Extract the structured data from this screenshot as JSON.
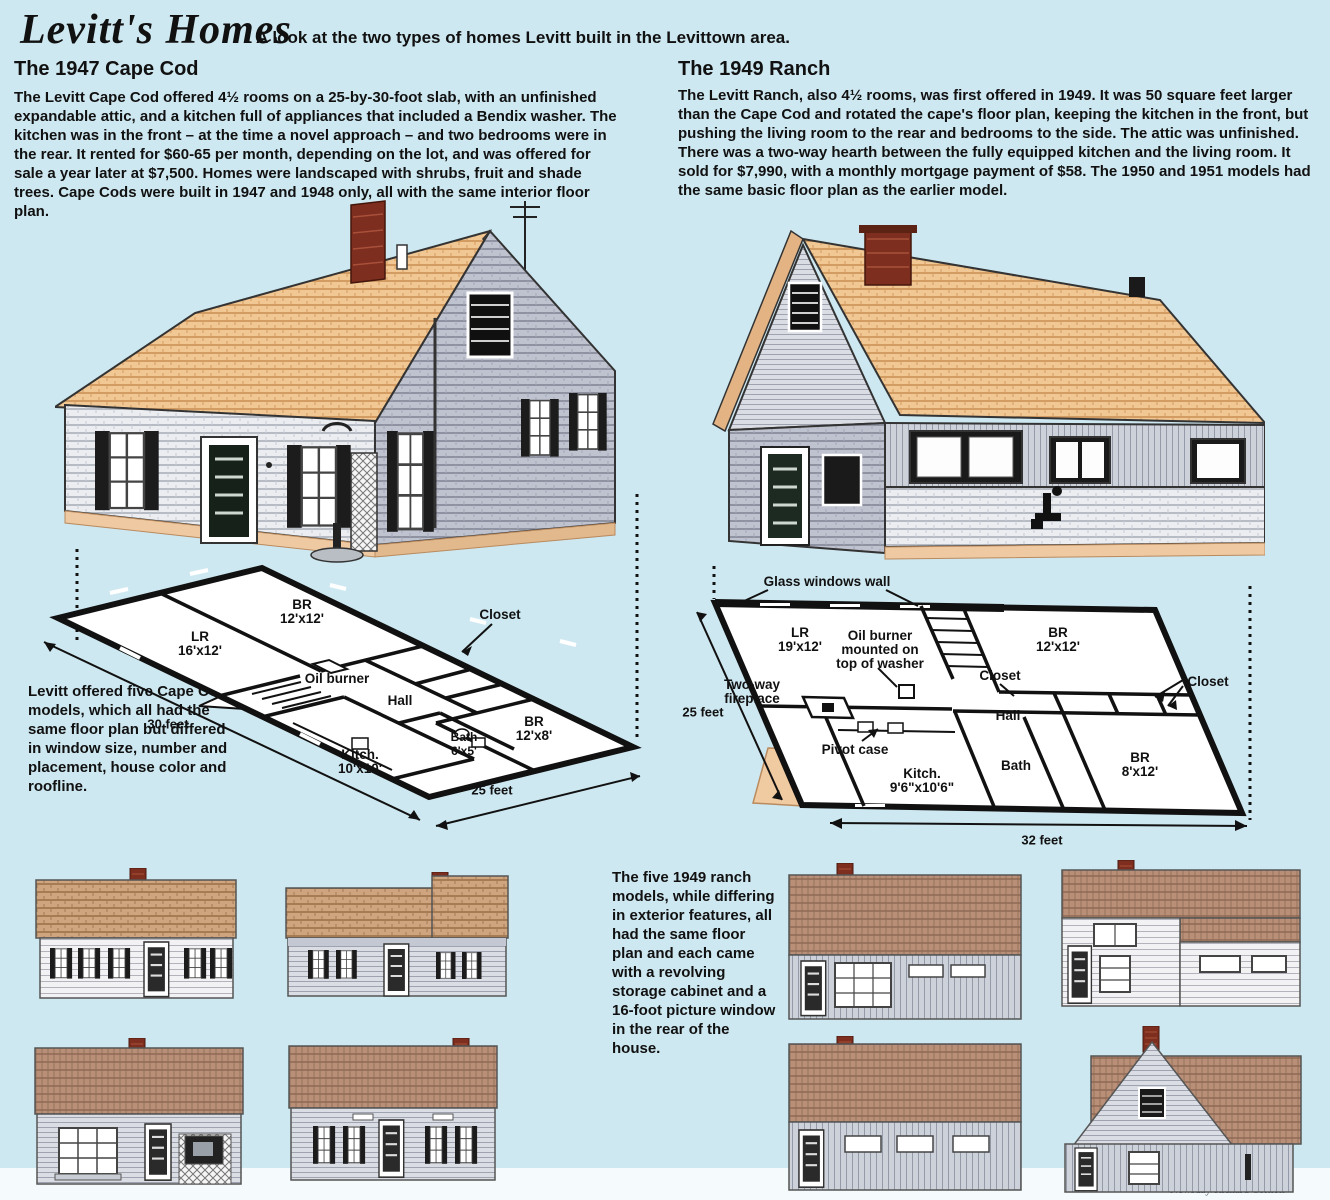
{
  "page": {
    "background": "#cee8f1",
    "bottom_strip": "#f5fbfd",
    "plan_wall_color": "#111111",
    "roof_peach": "#f1c793",
    "roof_brown": "#bb9177",
    "chimney_red": "#7d2e1e",
    "stoop_tan": "#f0caa0"
  },
  "header": {
    "title": "Levitt's Homes",
    "subtitle": "A look at the two types of homes Levitt built in the Levittown area."
  },
  "cape": {
    "heading": "The 1947 Cape Cod",
    "body": "The Levitt Cape Cod offered 4½ rooms on a 25-by-30-foot slab, with an unfinished expandable attic, and a kitchen full of appliances that included a Bendix washer. The kitchen was in the front – at the time a novel approach – and two bedrooms were in the rear. It rented for $60-65 per month, depending on the lot, and was offered for sale a year later at $7,500. Homes were landscaped with shrubs, fruit and shade trees. Cape Cods were built in 1947 and 1948 only, all with the same interior floor plan.",
    "side_note": "Levitt offered five Cape Cod models, which all had the same floor plan but differed in window size, number and placement, house color and roofline.",
    "plan": {
      "rooms": {
        "lr": {
          "name": "LR",
          "dims": "16'x12'"
        },
        "br1": {
          "name": "BR",
          "dims": "12'x12'"
        },
        "br2": {
          "name": "BR",
          "dims": "12'x8'"
        },
        "bath": {
          "name": "Bath",
          "dims": "6'x5'"
        },
        "kitch": {
          "name": "Kitch.",
          "dims": "10'x10'"
        }
      },
      "labels": {
        "closet": "Closet",
        "oil_burner": "Oil burner",
        "hall": "Hall"
      },
      "dims": {
        "width": "30 feet",
        "depth": "25 feet"
      }
    }
  },
  "ranch": {
    "heading": "The 1949 Ranch",
    "body": "The Levitt Ranch, also 4½ rooms, was first offered in 1949. It was 50 square feet larger than the Cape Cod and rotated the cape's floor plan, keeping the kitchen in the front, but pushing the living room to the rear and bedrooms to the side. The attic was unfinished. There was a two-way hearth between the fully equipped kitchen and the living room.  It sold for $7,990, with a monthly mortgage payment of $58. The 1950 and 1951 models had the same basic floor plan as the earlier model.",
    "plan": {
      "rooms": {
        "lr": {
          "name": "LR",
          "dims": "19'x12'"
        },
        "br1": {
          "name": "BR",
          "dims": "12'x12'"
        },
        "br2": {
          "name": "BR",
          "dims": "8'x12'"
        },
        "bath": {
          "name": "Bath",
          "dims": ""
        },
        "kitch": {
          "name": "Kitch.",
          "dims": "9'6\"x10'6\""
        }
      },
      "labels": {
        "glass_wall": "Glass windows wall",
        "oil_burner": "Oil burner mounted on top of washer",
        "fireplace": "Two-way fireplace",
        "pivot": "Pivot case",
        "hall": "Hall",
        "closet_a": "Closet",
        "closet_b": "Closet"
      },
      "dims": {
        "width": "32 feet",
        "depth": "25 feet"
      }
    }
  },
  "models_note": "The five 1949 ranch models, while differing in exterior features, all had the same floor plan and each came with a revolving storage cabinet and a 16-foot picture window in the rear of the house.",
  "credit": "Newsday/Richard Cornett"
}
